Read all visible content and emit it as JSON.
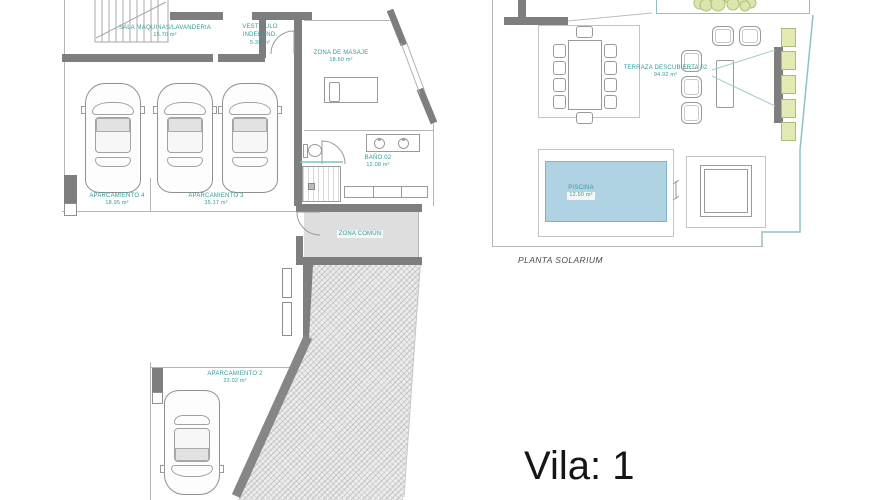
{
  "plans": {
    "basement": {
      "rooms": {
        "sala_maquinas": {
          "label": "SALA MÁQUINAS/LAVANDERIA",
          "area": "15.70 m²"
        },
        "vestibulo": {
          "label": "VESTÍBULO",
          "sublabel": "INDEPEND.",
          "area": "5.28 m²"
        },
        "zona_masaje": {
          "label": "ZONA DE MASAJE",
          "area": "18.50 m²"
        },
        "bano_02": {
          "label": "BAÑO 02",
          "area": "12.08 m²"
        },
        "zona_comun": {
          "label": "ZONA COMÚN"
        },
        "aparcamiento_4": {
          "label": "APARCAMIENTO 4",
          "area": "18.95 m²"
        },
        "aparcamiento_3": {
          "label": "APARCAMIENTO 3",
          "area": "35.17 m²"
        },
        "aparcamiento_2": {
          "label": "APARCAMIENTO 2",
          "area": "23.02 m²"
        }
      }
    },
    "solarium": {
      "caption": "PLANTA SOLARIUM",
      "rooms": {
        "terraza": {
          "label": "TERRAZA DESCUBIERTA 02",
          "area": "94.92 m²"
        },
        "piscina": {
          "label": "PISCINA",
          "area": "12.50 m²"
        }
      }
    }
  },
  "logo": {
    "text": "Vila: 1"
  },
  "colors": {
    "wall": "#7e7e7e",
    "line": "#b5b5b5",
    "label": "#2f9b9b",
    "pool": "#b0d3e4",
    "poolb": "#7fb2cd",
    "hatchbg": "#ececec"
  }
}
